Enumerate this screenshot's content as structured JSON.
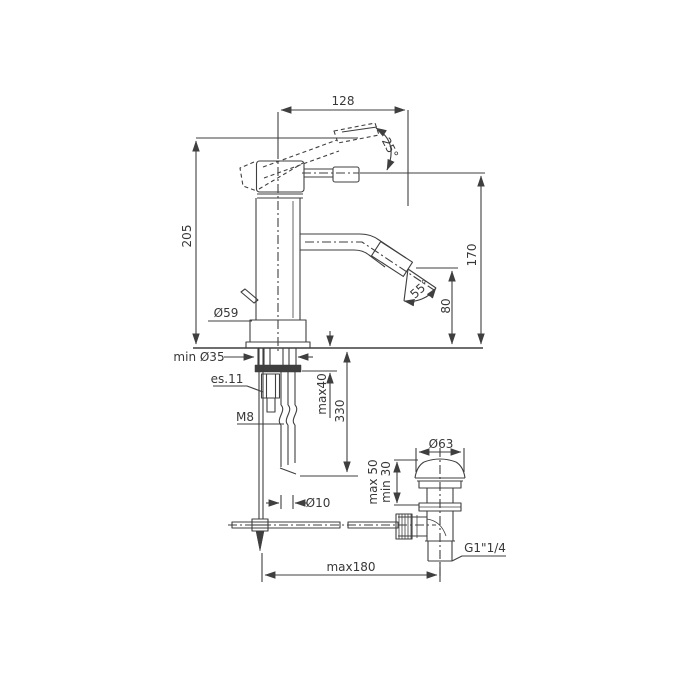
{
  "drawing": {
    "type": "technical-dimension-drawing",
    "subject": "single-lever bidet mixer tap with pop-up waste, side elevation",
    "colors": {
      "line": "#3f3f3f",
      "text": "#383838",
      "background": "#ffffff"
    },
    "labels": {
      "dim_width_top": "128",
      "angle_lever": "25°",
      "dim_height_body": "205",
      "dim_height_lever": "170",
      "dim_spout_outlet_height": "80",
      "angle_spray": "55°",
      "dia_base": "Ø59",
      "dia_hole_min": "min Ø35",
      "hex_key": "es.11",
      "thread_stud": "M8",
      "max_counter_thickness": "max40",
      "hose_length": "330",
      "dia_hose": "Ø10",
      "dia_drain_cap": "Ø63",
      "drain_range_max": "max 50",
      "drain_range_min": "min 30",
      "thread_drain": "G1\"1/4",
      "dim_reach_bottom": "max180"
    }
  }
}
